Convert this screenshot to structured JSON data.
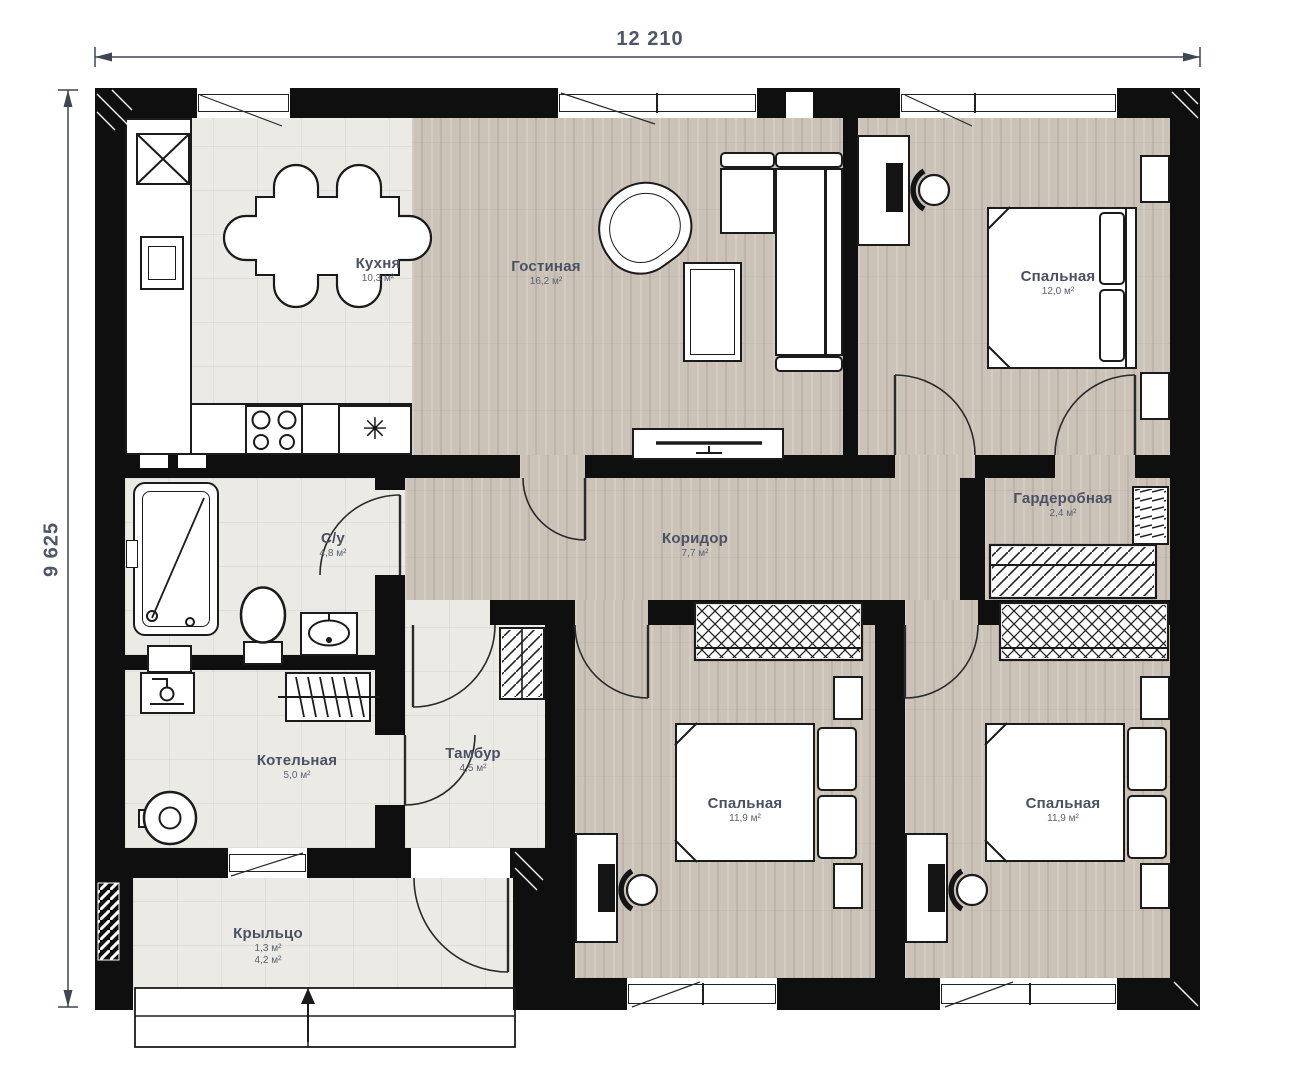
{
  "plan": {
    "dimensions": {
      "width": "12 210",
      "height": "9 625"
    },
    "rooms": {
      "kitchen": {
        "name": "Кухня",
        "area": "10,3 м²"
      },
      "living": {
        "name": "Гостиная",
        "area": "16,2 м²"
      },
      "bedroom_tr": {
        "name": "Спальная",
        "area": "12,0 м²"
      },
      "wardrobe": {
        "name": "Гардеробная",
        "area": "2,4 м²"
      },
      "corridor": {
        "name": "Коридор",
        "area": "7,7 м²"
      },
      "bathroom": {
        "name": "С/у",
        "area": "4,8 м²"
      },
      "boiler": {
        "name": "Котельная",
        "area": "5,0 м²"
      },
      "vestibule": {
        "name": "Тамбур",
        "area": "4,5 м²"
      },
      "bedroom_bm": {
        "name": "Спальная",
        "area": "11,9 м²"
      },
      "bedroom_br": {
        "name": "Спальная",
        "area": "11,9 м²"
      },
      "porch": {
        "name": "Крыльцо",
        "area1": "1,3 м²",
        "area2": "4,2 м²"
      }
    },
    "icons": {
      "washer": "✳"
    },
    "colors": {
      "wall": "#0f0f0f",
      "wood_floor": "#cbc2b8",
      "tile_floor": "#ebeae5",
      "label": "#4a5164",
      "dimension": "#4e5668"
    }
  }
}
